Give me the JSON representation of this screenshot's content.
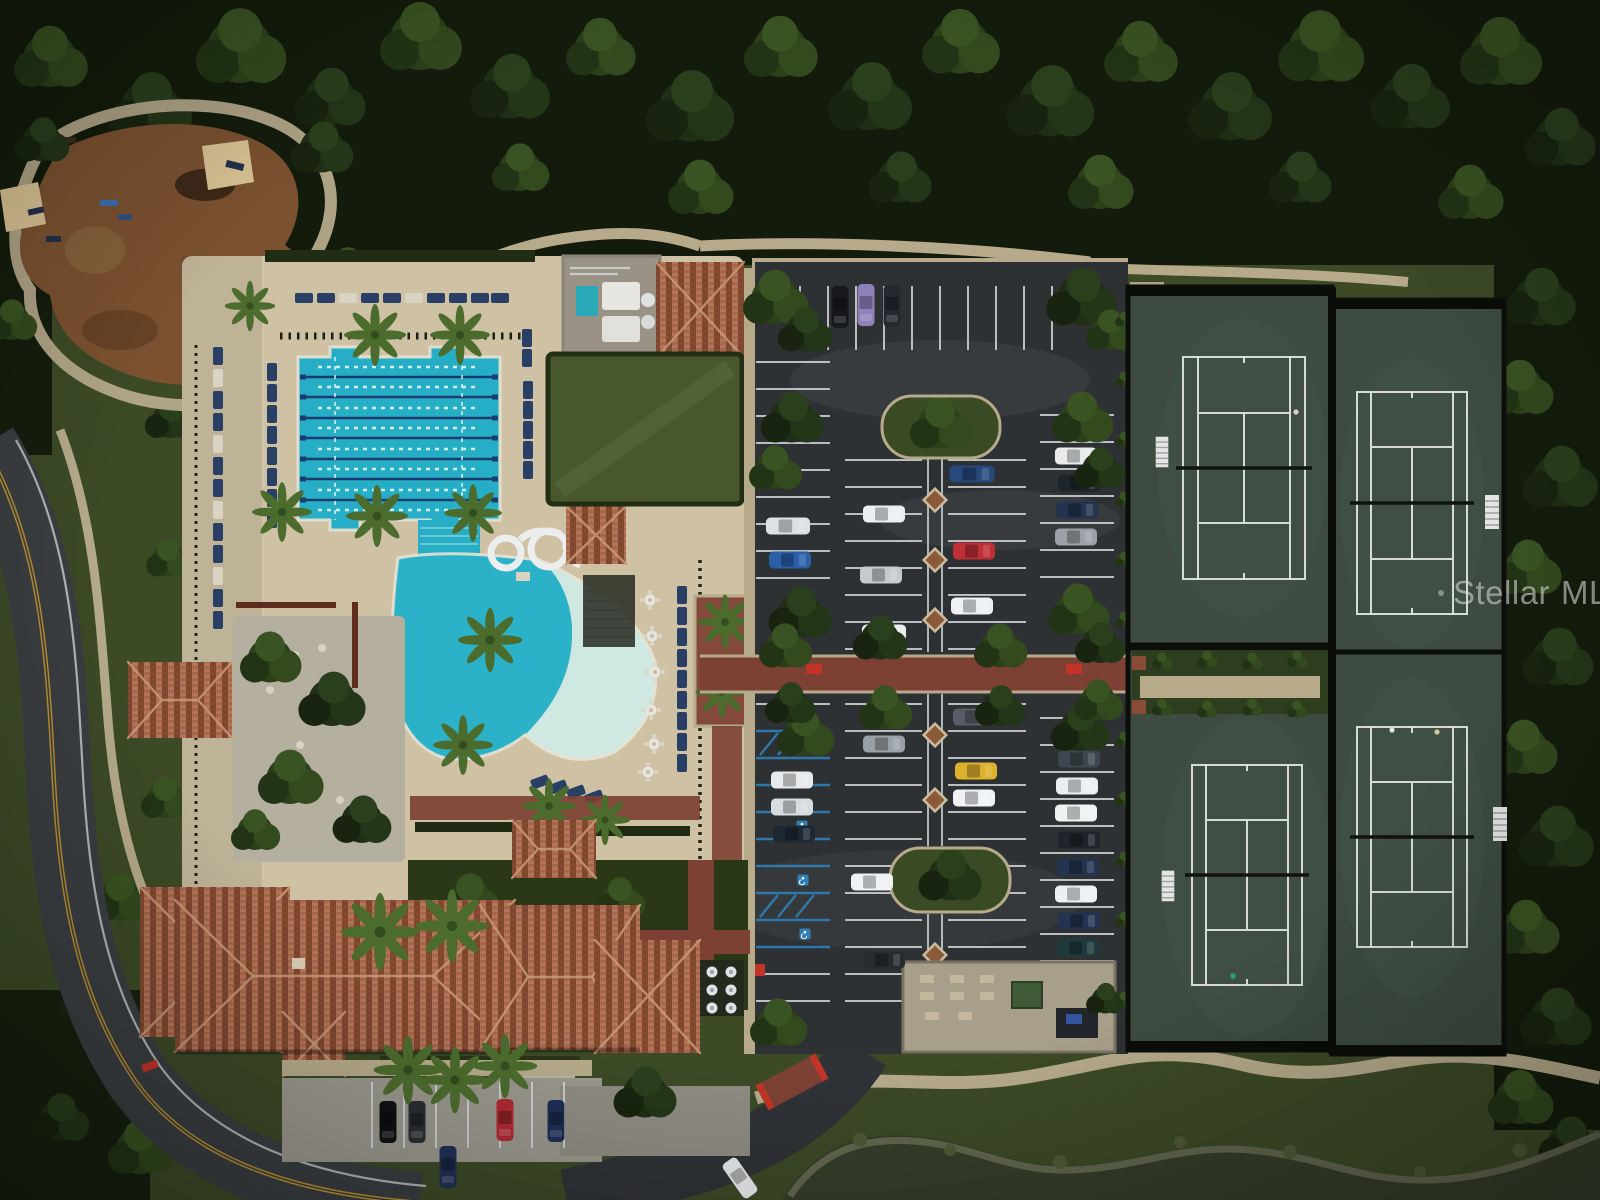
{
  "meta": {
    "type": "aerial-drone-photo",
    "description": "Overhead aerial photo of a community amenity campus: resort pool complex with lap pool, figure-eight water slide and zero-entry lagoon pool, tile-roof clubhouse, central parking lot with landscaped islands, four tennis courts, playground with shade sails, event lawn, perimeter road, winding paths and a pond, all surrounded by dense tree canopy."
  },
  "watermark": {
    "dot": "",
    "word1": "Stellar",
    "word2": "MLS",
    "color": "#d8dadc",
    "opacity": 0.58
  },
  "scene": {
    "labels": {
      "playground": "Playground with shade sails",
      "lap_pool": "Eight-lane lap pool",
      "lagoon_pool": "Zero-entry lagoon pool",
      "water_slide": "Figure-eight water slide",
      "event_lawn": "Event lawn",
      "spa_building": "Spa and pool equipment building",
      "clubhouse": "Clubhouse with barrel-tile roof",
      "parking_lot": "Parking lot",
      "promenade": "Brick pedestrian promenade",
      "tennis": "Tennis courts",
      "pond": "Pond",
      "road": "Perimeter road",
      "maintenance_yard": "Walled patio / maintenance yard"
    },
    "counts": {
      "lap_pool_lanes": 8,
      "tennis_courts": 4,
      "shade_sails": 2,
      "slide_loops": 2,
      "parked_cars": 40,
      "handicap_spaces": 4,
      "round_tables": 6
    },
    "palette": {
      "forest": "#16200f",
      "grass": "#3c4a26",
      "lawn": "#49582c",
      "pool_water": "#25aec6",
      "lagoon_shallow": "#cfe8e1",
      "lane_rope": "#1d3c6e",
      "deck": "#cfc2a4",
      "asphalt": "#2d3134",
      "brick": "#7c4134",
      "red_marking": "#c03527",
      "roof_terracotta": "#9a5a40",
      "court_surface": "#3d4b40",
      "court_line": "#e2e8e0",
      "lounger_navy": "#2a3f66",
      "road": "#3a3e41",
      "road_yellow": "#c9992f",
      "pond": "#353d2a",
      "handicap_blue": "#2f7fb5",
      "mulch": "#7b5130",
      "shade_sail": "#d8c294",
      "watermark": "#d8dadc"
    }
  }
}
